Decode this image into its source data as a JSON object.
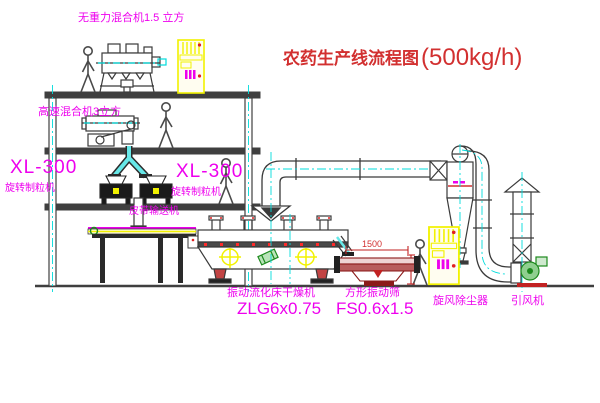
{
  "title": {
    "main": "农药生产线流程图",
    "capacity": "(500kg/h)"
  },
  "labels": {
    "top_mixer": "无重力混合机1.5 立方",
    "floor2_mixer": "高速混合机3立方",
    "granulator_left_model": "XL-300",
    "granulator_left_name": "旋转制粒机",
    "granulator_right_model": "XL-300",
    "granulator_right_name": "旋转制粒机",
    "belt_conveyor": "皮带输送机",
    "dryer_name": "振动流化床干燥机",
    "dryer_model": "ZLG6x0.75",
    "sieve_name": "方形振动筛",
    "sieve_model": "FS0.6x1.5",
    "cyclone": "旋风除尘器",
    "fan": "引风机",
    "dim_sieve_width": "1500"
  },
  "colors": {
    "line": "#404040",
    "centerline_cyan": "#00dcdc",
    "label_magenta": "#ee00ee",
    "title_red": "#d23030",
    "highlight_yellow": "#f2f200",
    "equipment_green": "#1d8a1d",
    "equipment_red": "#c22222",
    "background": "#ffffff"
  }
}
